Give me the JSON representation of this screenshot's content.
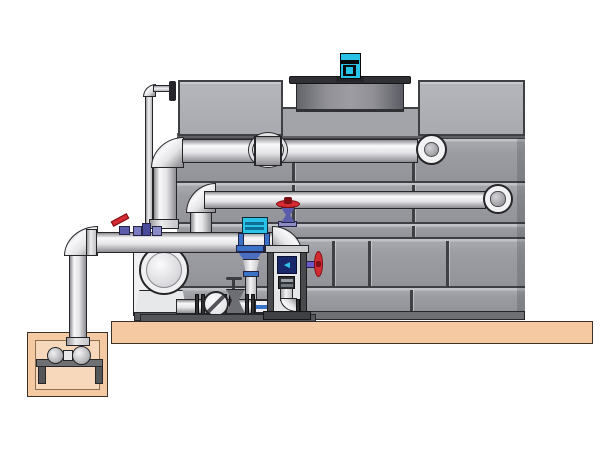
{
  "diagram": {
    "kind": "technical-illustration",
    "subject": "factory-assembled cooling tower with circulation pump skid, suction header, instrument stand and below-grade sump pump pit",
    "components": [
      "cooling-tower-casing",
      "tower-top-left-tank",
      "tower-top-right-tank",
      "fan-cowl",
      "fan-motor",
      "hot-water-inlet-pipe",
      "tower-return-pipe",
      "make-up-water-pipe",
      "wall-sleeve",
      "suction-header-pipe",
      "riser-pipe",
      "sump-pit",
      "sump-pump-set",
      "sump-pump-stand",
      "circulation-pump",
      "check-valve",
      "gate-valve",
      "flexible-coupling",
      "ball-valve-red-lever",
      "solenoid-fittings",
      "butterfly-valve-actuator",
      "flow-control-valve",
      "vent-gate-valve-red-handwheel",
      "instrument-stand",
      "level-display",
      "drain-elbow",
      "side-gate-valve-red-handwheel",
      "concrete-slab",
      "skid-base-rail"
    ]
  },
  "icons": {
    "level_display_arrow": "◄"
  },
  "colors": {
    "outline": "#26262a",
    "panel": "#9a9ca2",
    "panel_hi": "#c0c2c6",
    "panel_line": "#3e4044",
    "box": "#a8aab0",
    "box_hi": "#c8cacd",
    "recess": "#a2a4aa",
    "base_band": "#6e7074",
    "cowl": "#8e8e92",
    "cowl_rim": "#303134",
    "motor_cyan": "#29c3e8",
    "pipe_hi": "#f8f8fa",
    "pipe_mid": "#e4e4e6",
    "pipe_lo": "#8e8e92",
    "slab": "#f5c9a2",
    "slab_edge": "#3c3228",
    "sump_inner": "#f8d8ba",
    "steel": "#55565a",
    "steel_dark": "#2e2f33",
    "frame_light": "#e4e6e8",
    "red": "#d42a32",
    "red_dark": "#7c0e14",
    "purple": "#5c5cac",
    "purple_dark": "#23234a",
    "blue": "#3a72c8",
    "navy": "#18286a",
    "cyan": "#2ec6ee",
    "white_part": "#f0f0f2"
  }
}
